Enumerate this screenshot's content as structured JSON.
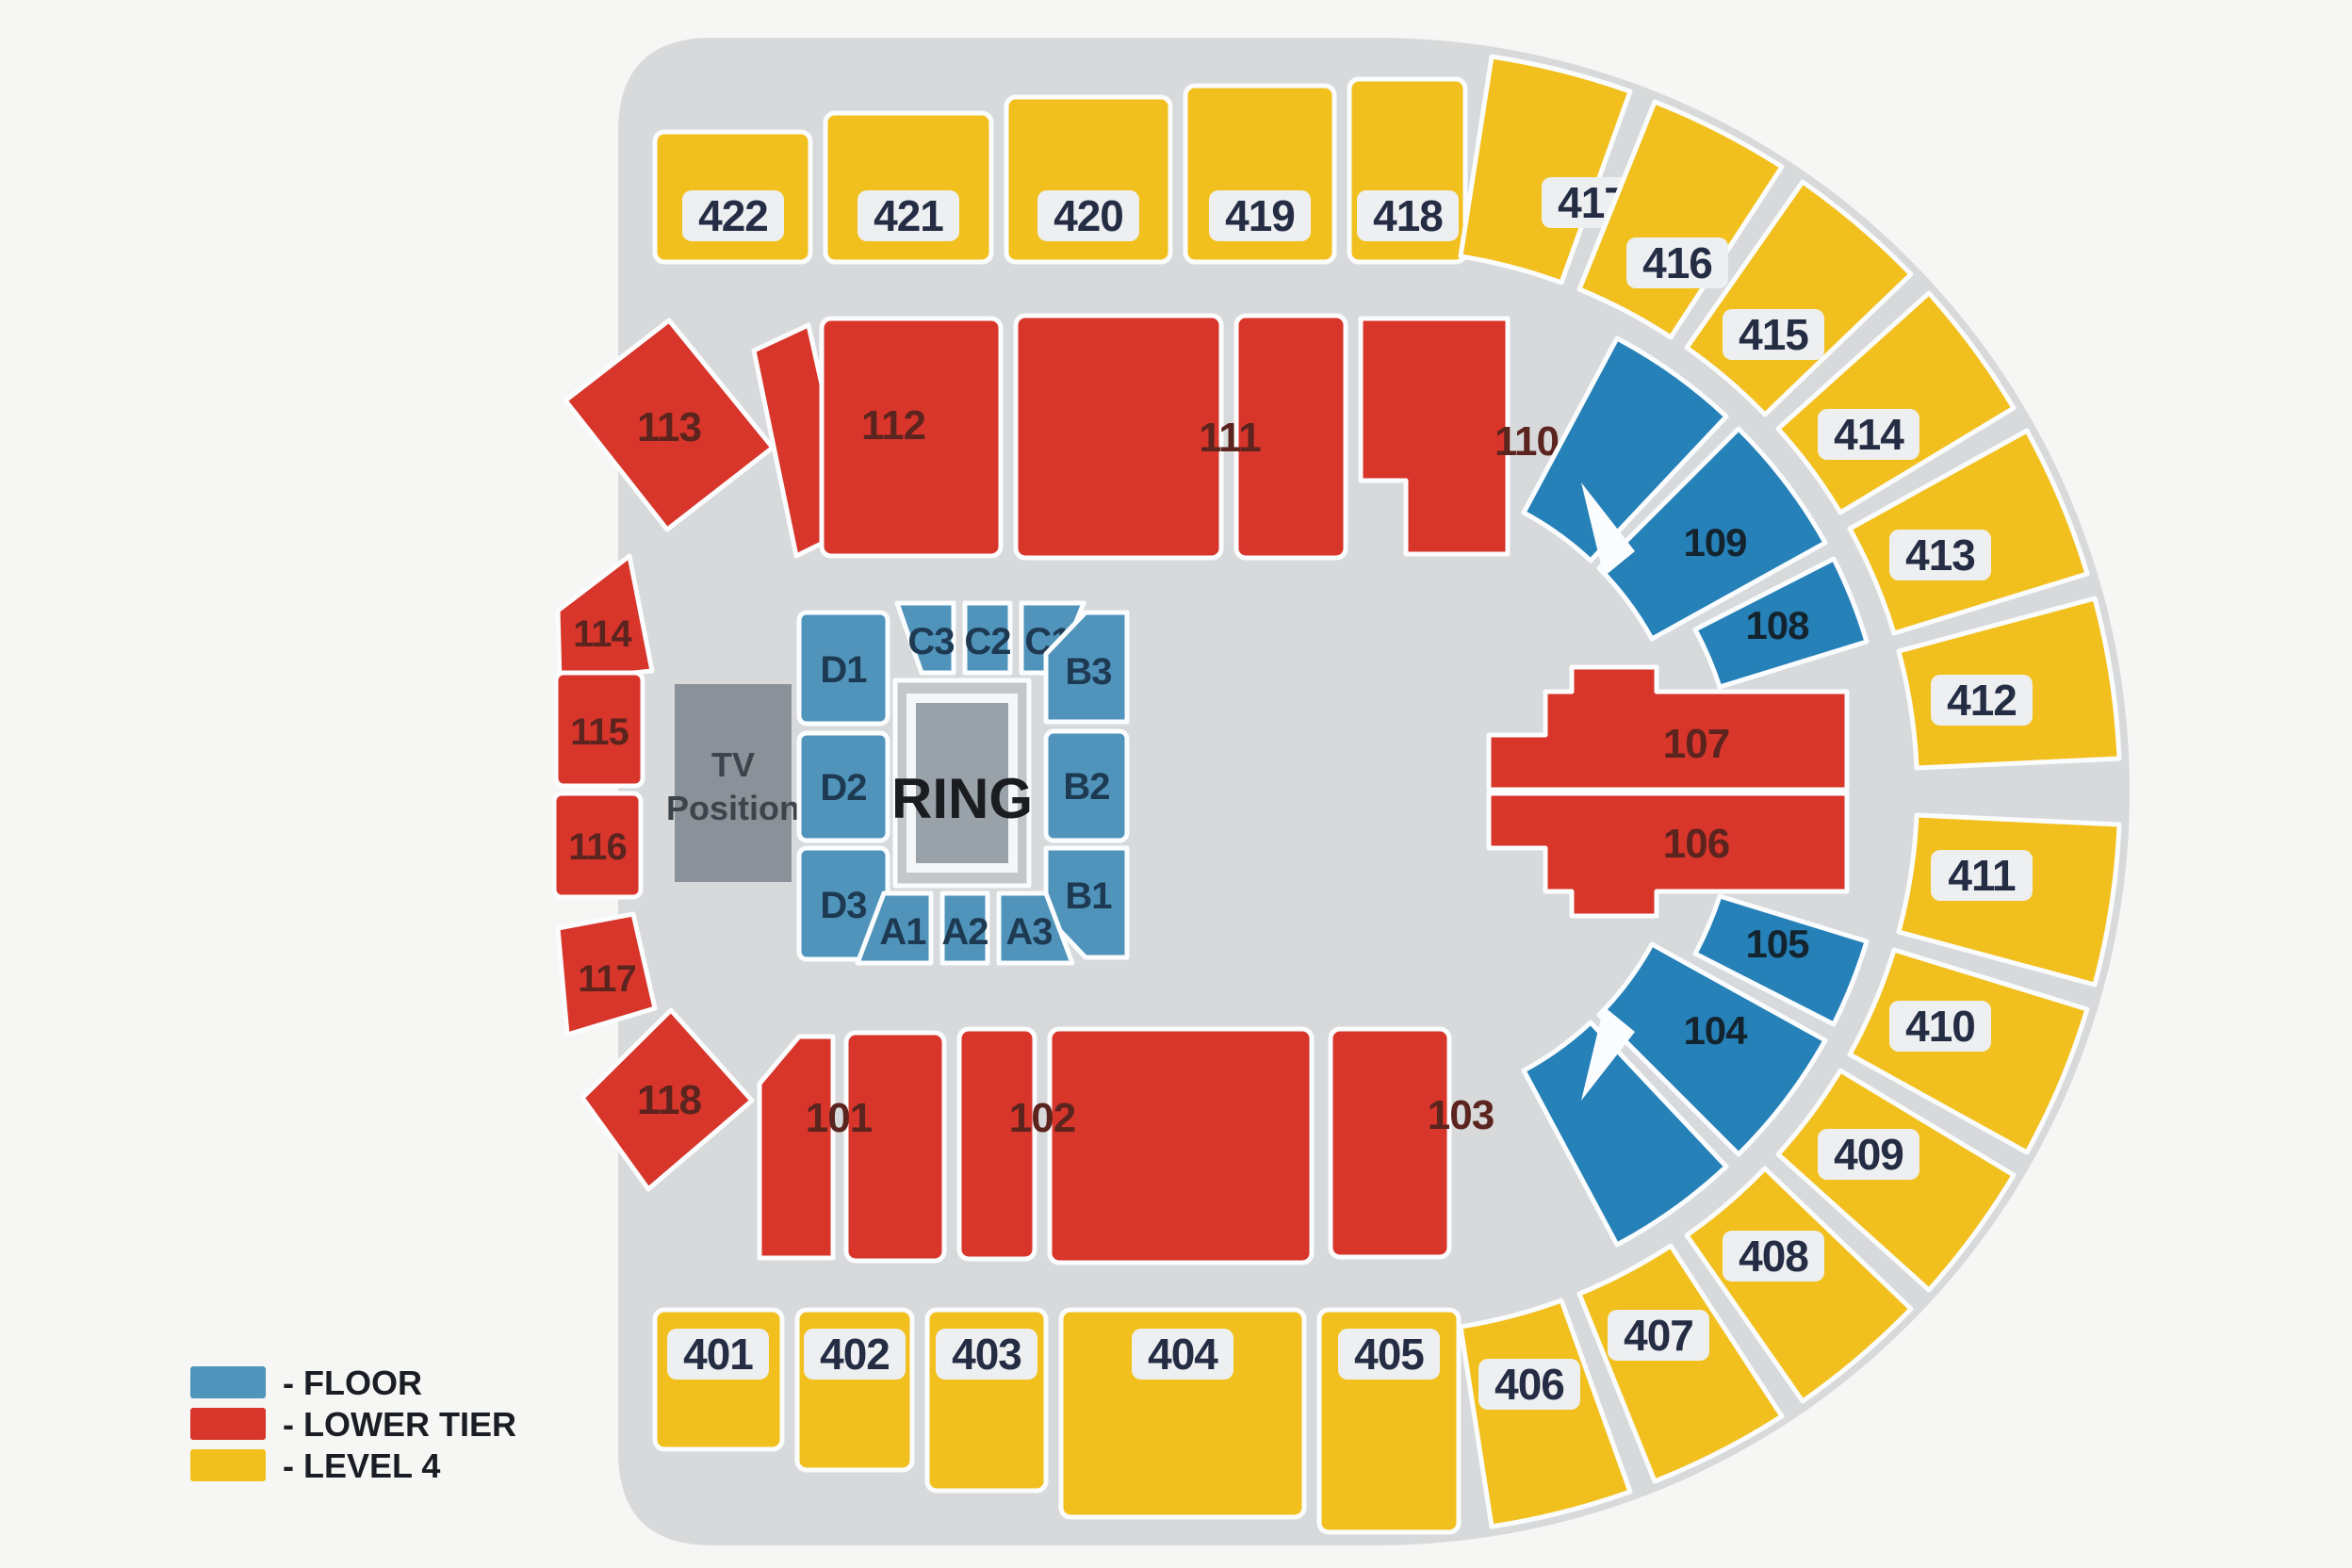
{
  "title": "Arena boxing seating plan",
  "legend": {
    "items": [
      {
        "label": "- FLOOR",
        "swatch": "floor"
      },
      {
        "label": "- LOWER TIER",
        "swatch": "lower_tier"
      },
      {
        "label": "- LEVEL 4",
        "swatch": "level4"
      }
    ]
  },
  "colors": {
    "floor": "#5094bc",
    "floor_tier": "#2581b8",
    "lower_tier": "#d8352b",
    "level4": "#f2c01e",
    "arena_base": "#d7d9db",
    "tv_box": "#8a9198",
    "ring_plinth": "#c3c7cb",
    "ring_box": "#99a1a9"
  },
  "ring": {
    "label": "RING"
  },
  "tv_position": {
    "line1": "TV",
    "line2": "Position"
  },
  "labels": {
    "s101": "101",
    "s102": "102",
    "s103": "103",
    "s104": "104",
    "s105": "105",
    "s106": "106",
    "s107": "107",
    "s108": "108",
    "s109": "109",
    "s110": "110",
    "s111": "111",
    "s112": "112",
    "s113": "113",
    "s114": "114",
    "s115": "115",
    "s116": "116",
    "s117": "117",
    "s118": "118",
    "s401": "401",
    "s402": "402",
    "s403": "403",
    "s404": "404",
    "s405": "405",
    "s406": "406",
    "s407": "407",
    "s408": "408",
    "s409": "409",
    "s410": "410",
    "s411": "411",
    "s412": "412",
    "s413": "413",
    "s414": "414",
    "s415": "415",
    "s416": "416",
    "s417": "417",
    "s418": "418",
    "s419": "419",
    "s420": "420",
    "s421": "421",
    "s422": "422",
    "A1": "A1",
    "A2": "A2",
    "A3": "A3",
    "B1": "B1",
    "B2": "B2",
    "B3": "B3",
    "C1": "C1",
    "C2": "C2",
    "C3": "C3",
    "D1": "D1",
    "D2": "D2",
    "D3": "D3"
  }
}
